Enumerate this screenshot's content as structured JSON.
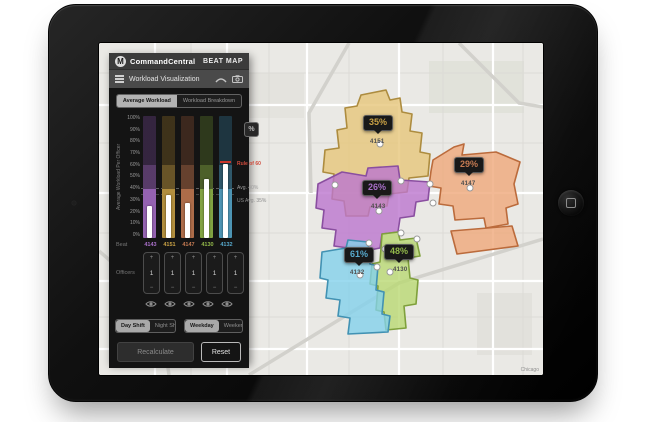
{
  "app": {
    "brand": "CommandCentral",
    "product": "BEAT MAP",
    "panel_title": "Workload Visualization"
  },
  "tabs": [
    {
      "label": "Average Workload",
      "active": true
    },
    {
      "label": "Workload Breakdown",
      "active": false
    }
  ],
  "chart": {
    "ylabel": "Average Workload Per Officer",
    "yticks": [
      "100%",
      "90%",
      "80%",
      "70%",
      "60%",
      "50%",
      "40%",
      "30%",
      "20%",
      "10%",
      "0%"
    ],
    "annotations": {
      "rule": "Rule of 60",
      "avg": "Avg. 40%",
      "us_avg": "US Avg. 35%"
    }
  },
  "chart_data": {
    "type": "bar",
    "categories": [
      "4143",
      "4151",
      "4147",
      "4130",
      "4132"
    ],
    "values": [
      26,
      35,
      29,
      48,
      61
    ],
    "ylabel": "Average Workload Per Officer",
    "ylim": [
      0,
      100
    ],
    "reference_lines": [
      {
        "label": "Rule of 60",
        "y": 60
      },
      {
        "label": "Avg. 40%",
        "y": 40
      },
      {
        "label": "US Avg. 35%",
        "y": 35
      }
    ]
  },
  "rows": {
    "beat_label": "Beat",
    "officers_label": "Officers"
  },
  "beats": [
    {
      "id": "4143",
      "pct_label": "26%",
      "value": 26,
      "officers": "1",
      "color": "#a86fc8",
      "map_fill": "#bb76ce",
      "map_stroke": "#8a4fa0"
    },
    {
      "id": "4151",
      "pct_label": "35%",
      "value": 35,
      "officers": "1",
      "color": "#c9a145",
      "map_fill": "#e6c67b",
      "map_stroke": "#ad8c3f"
    },
    {
      "id": "4147",
      "pct_label": "29%",
      "value": 29,
      "officers": "1",
      "color": "#c47a52",
      "map_fill": "#efa87b",
      "map_stroke": "#bb6b3c"
    },
    {
      "id": "4130",
      "pct_label": "48%",
      "value": 48,
      "officers": "1",
      "color": "#92b84a",
      "map_fill": "#b9d873",
      "map_stroke": "#7fa03c"
    },
    {
      "id": "4132",
      "pct_label": "61%",
      "value": 61,
      "officers": "1",
      "color": "#57a9cc",
      "map_fill": "#83d1eb",
      "map_stroke": "#4292b3"
    }
  ],
  "icons": {
    "logo": "motorola-m-logo",
    "menu": "hamburger-menu-icon",
    "collapse": "collapse-arc-icon",
    "camera": "camera-icon",
    "eye": "visibility-eye-icon",
    "percent": "%",
    "plus": "+",
    "minus": "−"
  },
  "controls": {
    "shift_options": [
      {
        "label": "Day Shift",
        "active": true
      },
      {
        "label": "Night Shift",
        "active": false
      }
    ],
    "day_options": [
      {
        "label": "Weekday",
        "active": true
      },
      {
        "label": "Weekend",
        "active": false
      }
    ],
    "recalculate_label": "Recalculate",
    "reset_label": "Reset"
  },
  "map": {
    "attribution": "Chicago",
    "background": "#eae9e5"
  }
}
